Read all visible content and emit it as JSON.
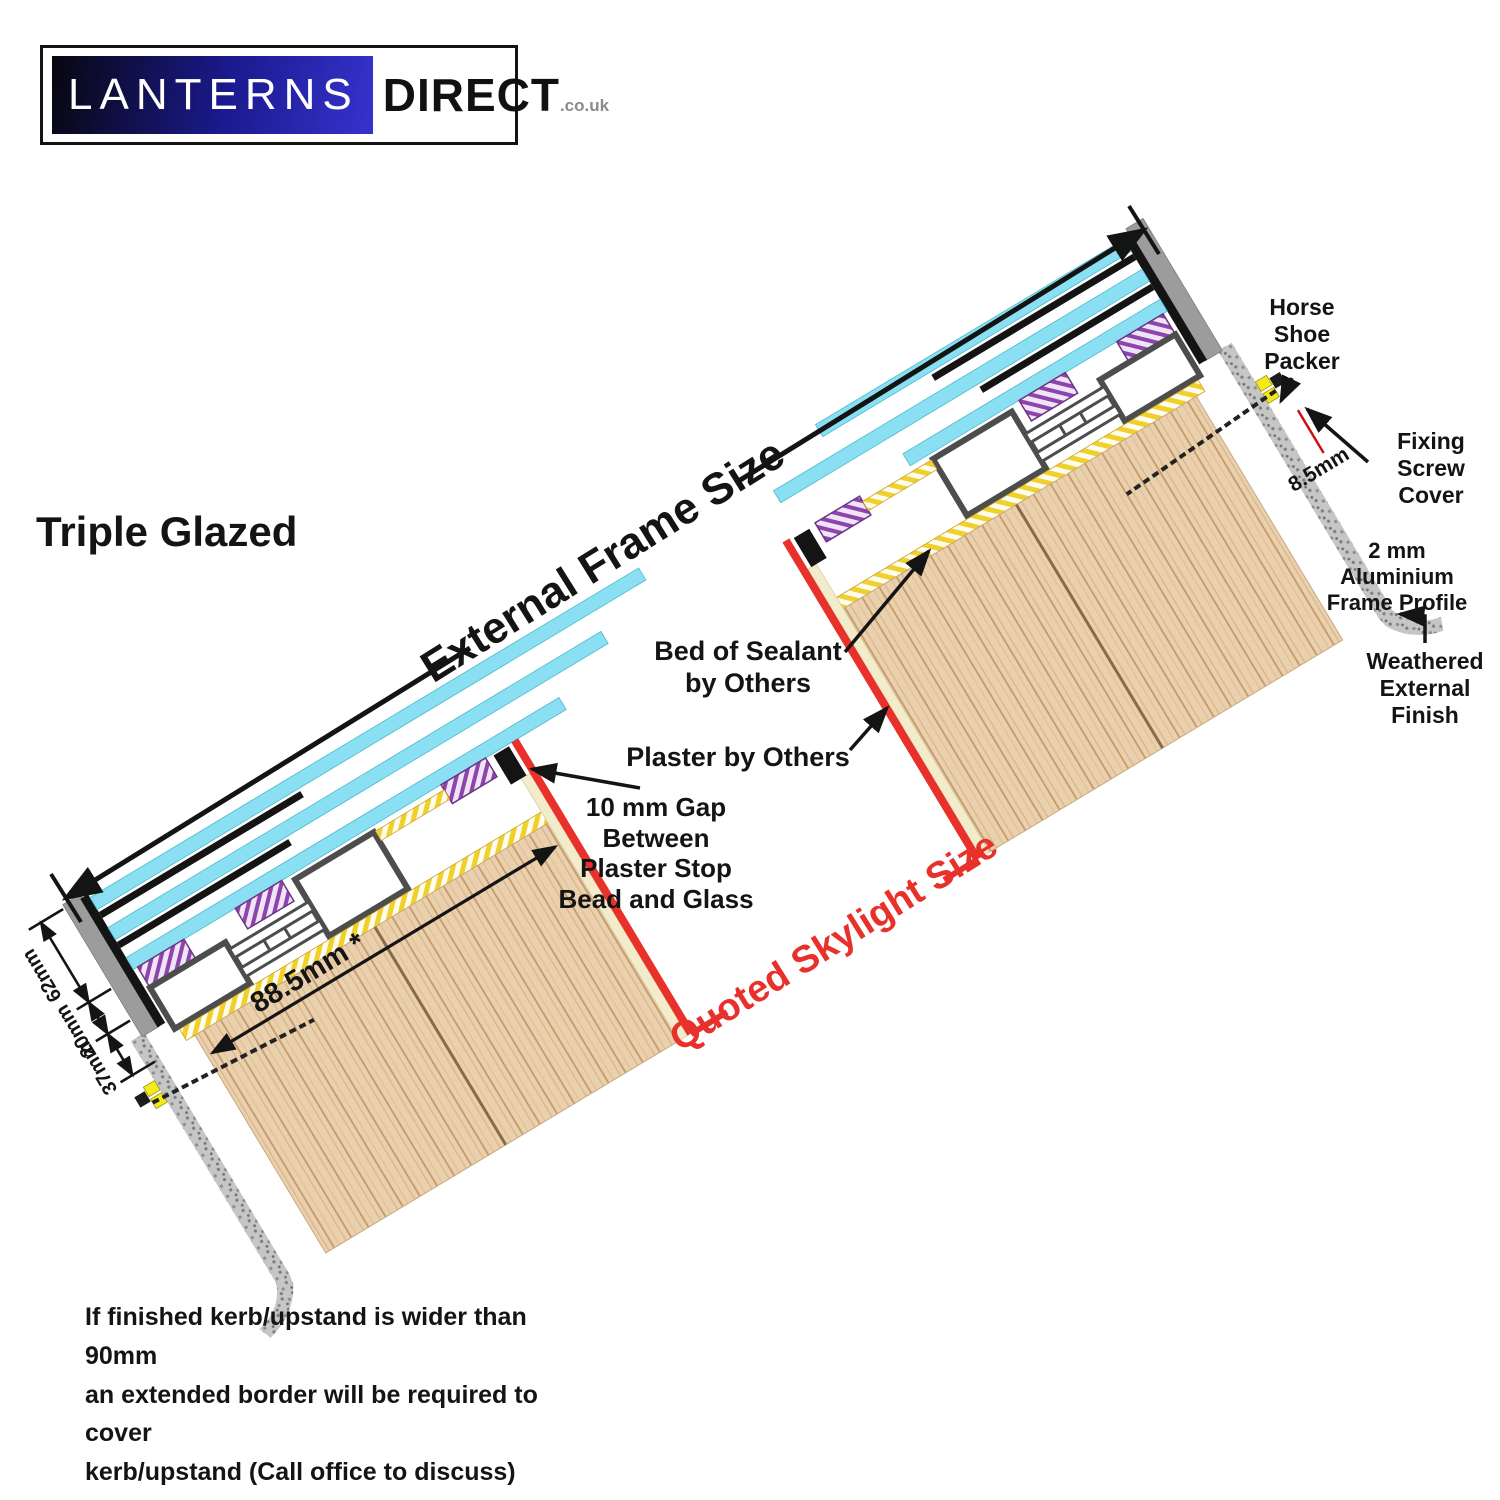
{
  "logo": {
    "brand_primary": "LANTERNS",
    "brand_secondary": "DIRECT",
    "brand_tld": ".co.uk"
  },
  "diagram": {
    "title": "Triple Glazed",
    "external_frame_label": "External Frame Size",
    "quoted_skylight_label": "Quoted Skylight Size",
    "annotations": {
      "horse_shoe_packer": "Horse\nShoe\nPacker",
      "fixing_screw_cover": "Fixing\nScrew\nCover",
      "profile_offset": "8.5mm",
      "aluminium_profile": "2 mm Aluminium\nFrame Profile",
      "bed_of_sealant": "Bed of Sealant\nby Others",
      "plaster": "Plaster by Others",
      "weathered_finish": "Weathered\nExternal\nFinish",
      "plaster_gap": "10 mm Gap\nBetween\nPlaster Stop\nBead and Glass"
    },
    "dimensions": {
      "glass_stack": "62mm",
      "frame_mid": "20mm",
      "frame_lower": "37mm",
      "kerb_width": "88.5mm *"
    },
    "footnote": "If finished kerb/upstand is wider than 90mm\nan extended border will be required to cover\nkerb/upstand (Call office to discuss)"
  },
  "colors": {
    "skylight_red": "#e8312a",
    "glass_cyan": "#8ae0f2",
    "logo_blue": "#3533cd",
    "wood": "#ead0ad"
  }
}
